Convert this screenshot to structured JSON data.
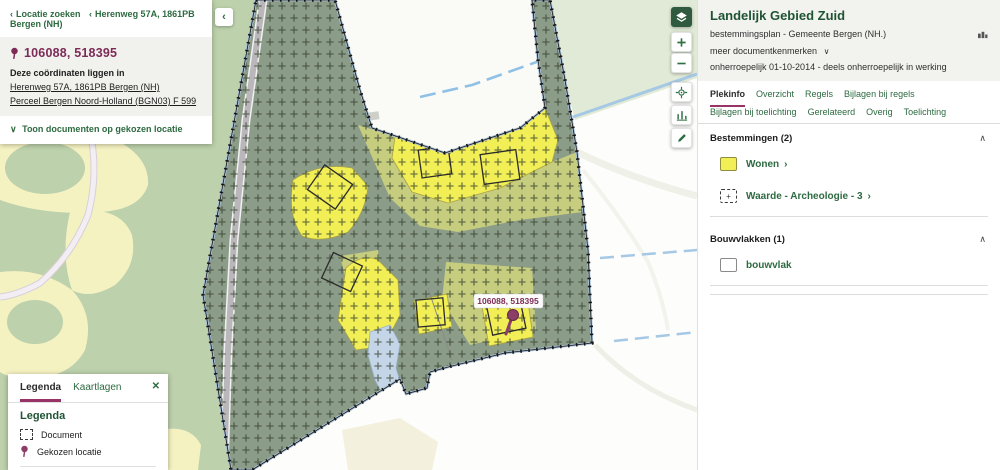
{
  "icons": {
    "chevron_left": "‹",
    "chevron_right": "›",
    "chevron_down": "∨",
    "chevron_up": "∧",
    "close": "✕",
    "plus": "+"
  },
  "location_panel": {
    "breadcrumb": {
      "search": "Locatie zoeken",
      "address": "Herenweg 57A, 1861PB Bergen (NH)"
    },
    "coordinates": "106088, 518395",
    "lies_in_heading": "Deze coördinaten liggen in",
    "link_address": "Herenweg 57A, 1861PB Bergen (NH)",
    "link_parcel": "Perceel Bergen Noord-Holland (BGN03) F 599",
    "toggle_documents": "Toon documenten op gekozen locatie"
  },
  "map": {
    "selected_coordinates_label": "106088, 518395",
    "control_icons": [
      "layers-icon",
      "zoom-in-icon",
      "zoom-out-icon",
      "locate-icon",
      "measure-icon",
      "draw-icon"
    ]
  },
  "legend_panel": {
    "tab_legenda": "Legenda",
    "tab_kaartlagen": "Kaartlagen",
    "heading": "Legenda",
    "item_document": "Document",
    "item_location": "Gekozen locatie"
  },
  "detail_panel": {
    "title": "Landelijk Gebied Zuid",
    "subtitle": "bestemmingsplan - Gemeente Bergen (NH.)",
    "more_link": "meer documentkenmerken",
    "status": "onherroepelijk 01-10-2014 - deels onherroepelijk in werking",
    "tabs": [
      "Plekinfo",
      "Overzicht",
      "Regels",
      "Bijlagen bij regels",
      "Bijlagen bij toelichting",
      "Gerelateerd",
      "Overig",
      "Toelichting"
    ],
    "active_tab": "Plekinfo",
    "sections": [
      {
        "heading": "Bestemmingen (2)",
        "items": [
          {
            "label": "Wonen"
          },
          {
            "label": "Waarde - Archeologie - 3"
          }
        ]
      },
      {
        "heading": "Bouwvlakken (1)",
        "items": [
          {
            "label": "bouwvlak"
          }
        ]
      }
    ]
  },
  "colors": {
    "accent_green": "#2d6a40",
    "dark_green": "#1e5434",
    "maroon": "#7c2b57",
    "tab_underline": "#973366",
    "wonen_yellow": "#f2ee55",
    "plan_sage": "#8b9c88"
  }
}
